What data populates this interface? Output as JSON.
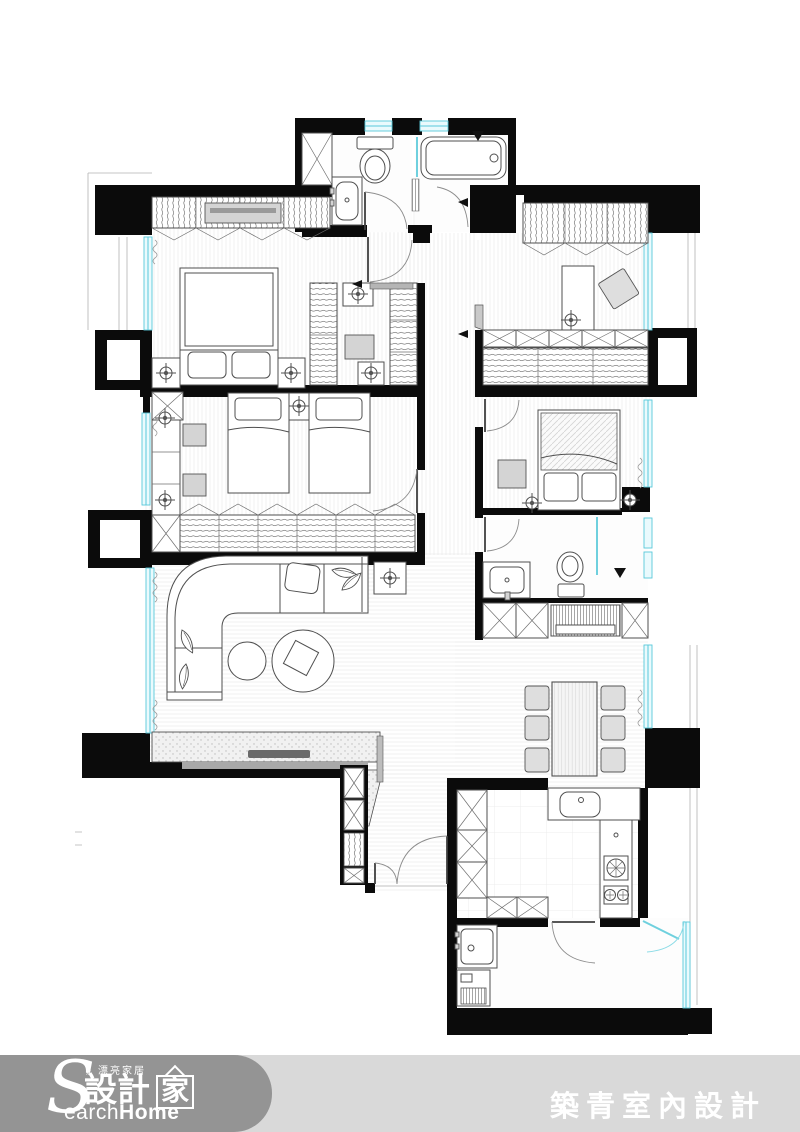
{
  "page": {
    "width": 800,
    "height": 1132,
    "background": "#ffffff"
  },
  "palette": {
    "bar": "#d9d9d9",
    "capsule": "#949494",
    "ftext": "#ffffff",
    "wall": "#0b0b0b",
    "window": "#58c8da"
  },
  "footer": {
    "logo": {
      "tagline": "》漂亮家居",
      "big_s": "S",
      "cjk": "設計",
      "house_char": "家",
      "latin_rest": "earch",
      "latin_bold": "Home"
    },
    "company_name": "築青室內設計"
  },
  "plan": {
    "icons": [
      "wardrobe-hanging-icon",
      "cabinet-x-icon",
      "ceiling-lamp-icon",
      "toilet-icon",
      "bathtub-icon",
      "sink-icon",
      "stove-burner-icon",
      "door-swing-icon",
      "window-band-icon",
      "curtain-icon",
      "sofa-icon",
      "bed-icon",
      "dining-table-icon",
      "tv-console-icon",
      "washer-icon"
    ]
  }
}
